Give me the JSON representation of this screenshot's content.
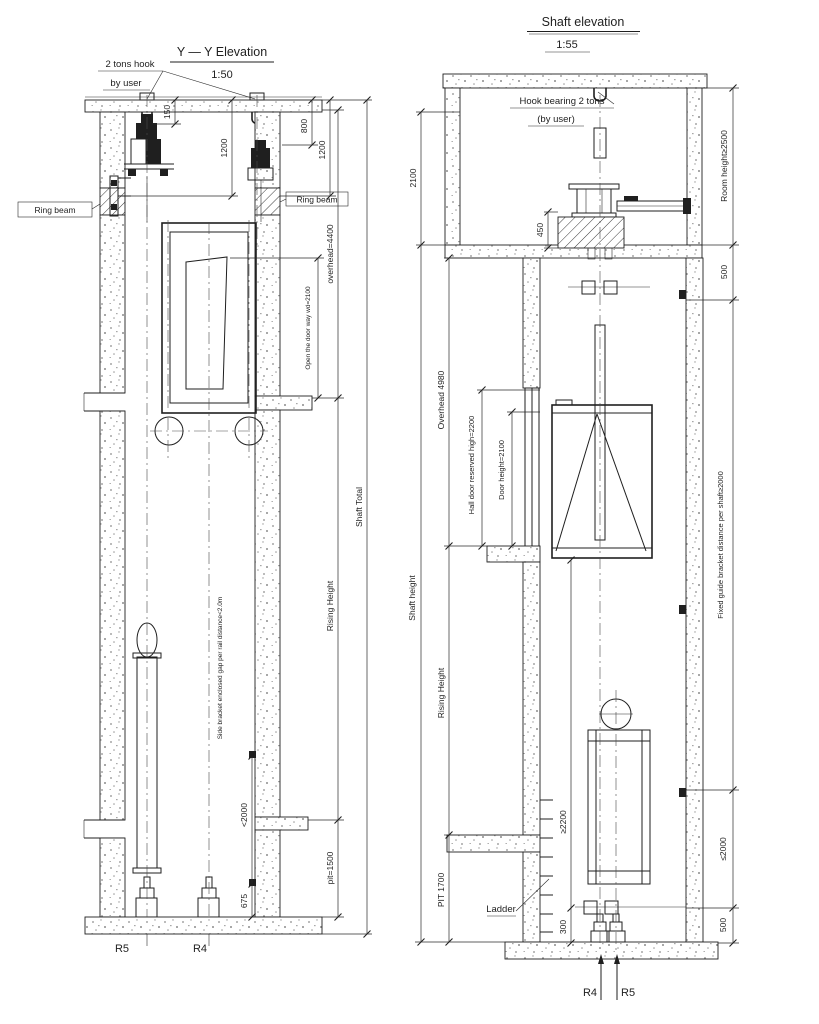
{
  "canvas": {
    "background": "#ffffff",
    "ink": "#1f1f1f"
  },
  "left_view": {
    "title": "Y — Y Elevation",
    "scale": "1:50",
    "note_hook_1": "2 tons hook",
    "note_hook_2": "by user",
    "label_ring_beam_left": "Ring beam",
    "label_ring_beam_right": "Ring beam",
    "dim_150": "150",
    "dim_1200_inner": "1200",
    "dim_800": "800",
    "dim_1200_outer": "1200",
    "dim_overhead": "overhead=4400",
    "dim_door_way": "Open the door way wd=2100",
    "dim_shaft_total": "Shaft Total",
    "dim_rising_height": "Rising Height",
    "note_bracket": "Side bracket enclosed gap per rail distance<2.0m",
    "dim_lt2000": "<2000",
    "dim_675": "675",
    "dim_pit": "pit=1500",
    "label_r5": "R5",
    "label_r4": "R4"
  },
  "right_view": {
    "title": "Shaft elevation",
    "scale": "1:55",
    "note_hook_1": "Hook bearing 2 tons",
    "note_hook_2": "(by user)",
    "dim_2100": "2100",
    "dim_450": "450",
    "dim_room_height": "Room height≥2500",
    "dim_500_top": "500",
    "dim_overhead": "Overhead 4980",
    "dim_hall_door": "Hall door reserved high=2200",
    "dim_door_height": "Door height=2100",
    "dim_guide_bracket": "Fixed guide bracket distance per shaft≥2000",
    "dim_shaft_height": "Shaft height",
    "dim_rising_height": "Rising Height",
    "dim_pit": "PIT 1700",
    "label_ladder": "Ladder",
    "dim_ge2200": "≥2200",
    "dim_300": "300",
    "dim_le2000": "≤2000",
    "dim_500_bottom": "500",
    "label_r4": "R4",
    "label_r5": "R5"
  }
}
